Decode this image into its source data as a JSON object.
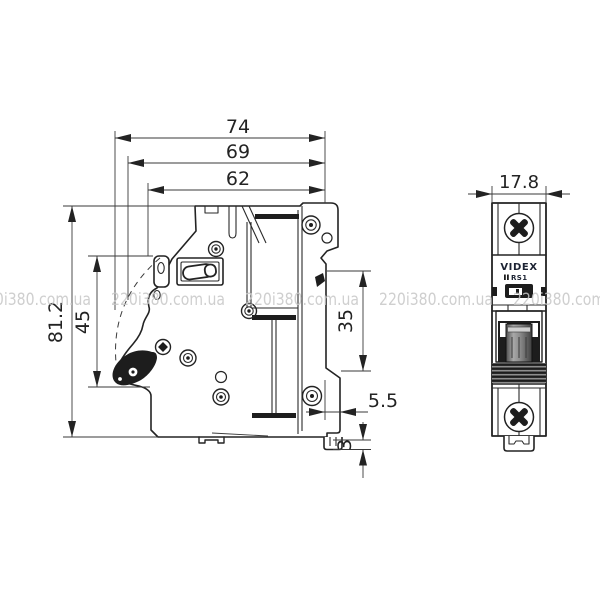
{
  "drawing": {
    "type": "technical-dimension-drawing",
    "subject": "single-pole DIN-rail circuit breaker, side view and front view"
  },
  "dimensions": {
    "total_depth": "74",
    "body_depth": "69",
    "front_depth": "62",
    "total_height": "81.2",
    "handle_zone_height": "45",
    "din_rail_opening": "35",
    "din_step_depth": "5.5",
    "clip_lip_height": "3",
    "module_width": "17.8"
  },
  "device": {
    "brand": "VIDEX",
    "model": "RS1"
  },
  "watermark": {
    "text": "220i380.com.ua",
    "color": "#c7c7c7"
  },
  "colors": {
    "line": "#232323",
    "background": "#ffffff",
    "toggle_dark": "#3f3f3f",
    "toggle_light": "#a8a8a8"
  }
}
